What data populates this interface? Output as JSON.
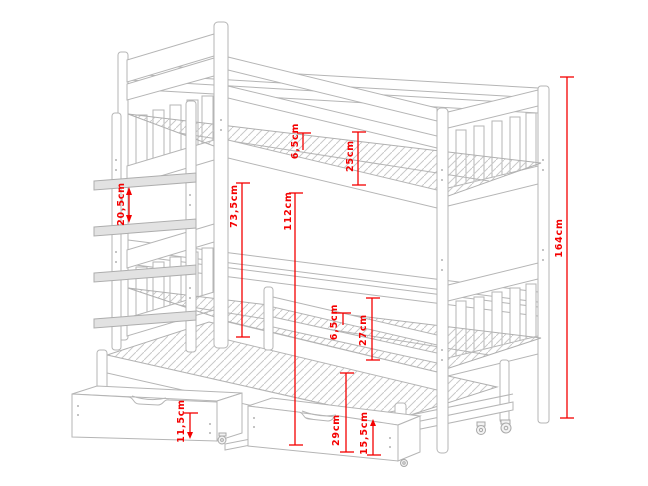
{
  "drawing": {
    "subject": "bunk bed with trundle bed, ladder and storage drawers - dimensioned technical drawing",
    "colors": {
      "outline": "#b5b5b5",
      "dimension": "#f40000",
      "background": "#ffffff"
    },
    "dimensions": [
      {
        "id": "upper-mattress-depth",
        "label": "6,5cm"
      },
      {
        "id": "upper-guard-rail",
        "label": "25cm"
      },
      {
        "id": "ladder-rung-spacing",
        "label": "20,5cm"
      },
      {
        "id": "bunk-clearance",
        "label": "73,5cm"
      },
      {
        "id": "upper-platform-height",
        "label": "112cm"
      },
      {
        "id": "overall-height",
        "label": "164cm"
      },
      {
        "id": "lower-mattress-depth",
        "label": "6,5cm"
      },
      {
        "id": "lower-guard-rail",
        "label": "27cm"
      },
      {
        "id": "drawer-height",
        "label": "11,5cm"
      },
      {
        "id": "lower-platform-height",
        "label": "29cm"
      },
      {
        "id": "trundle-height",
        "label": "15,5cm"
      }
    ]
  }
}
